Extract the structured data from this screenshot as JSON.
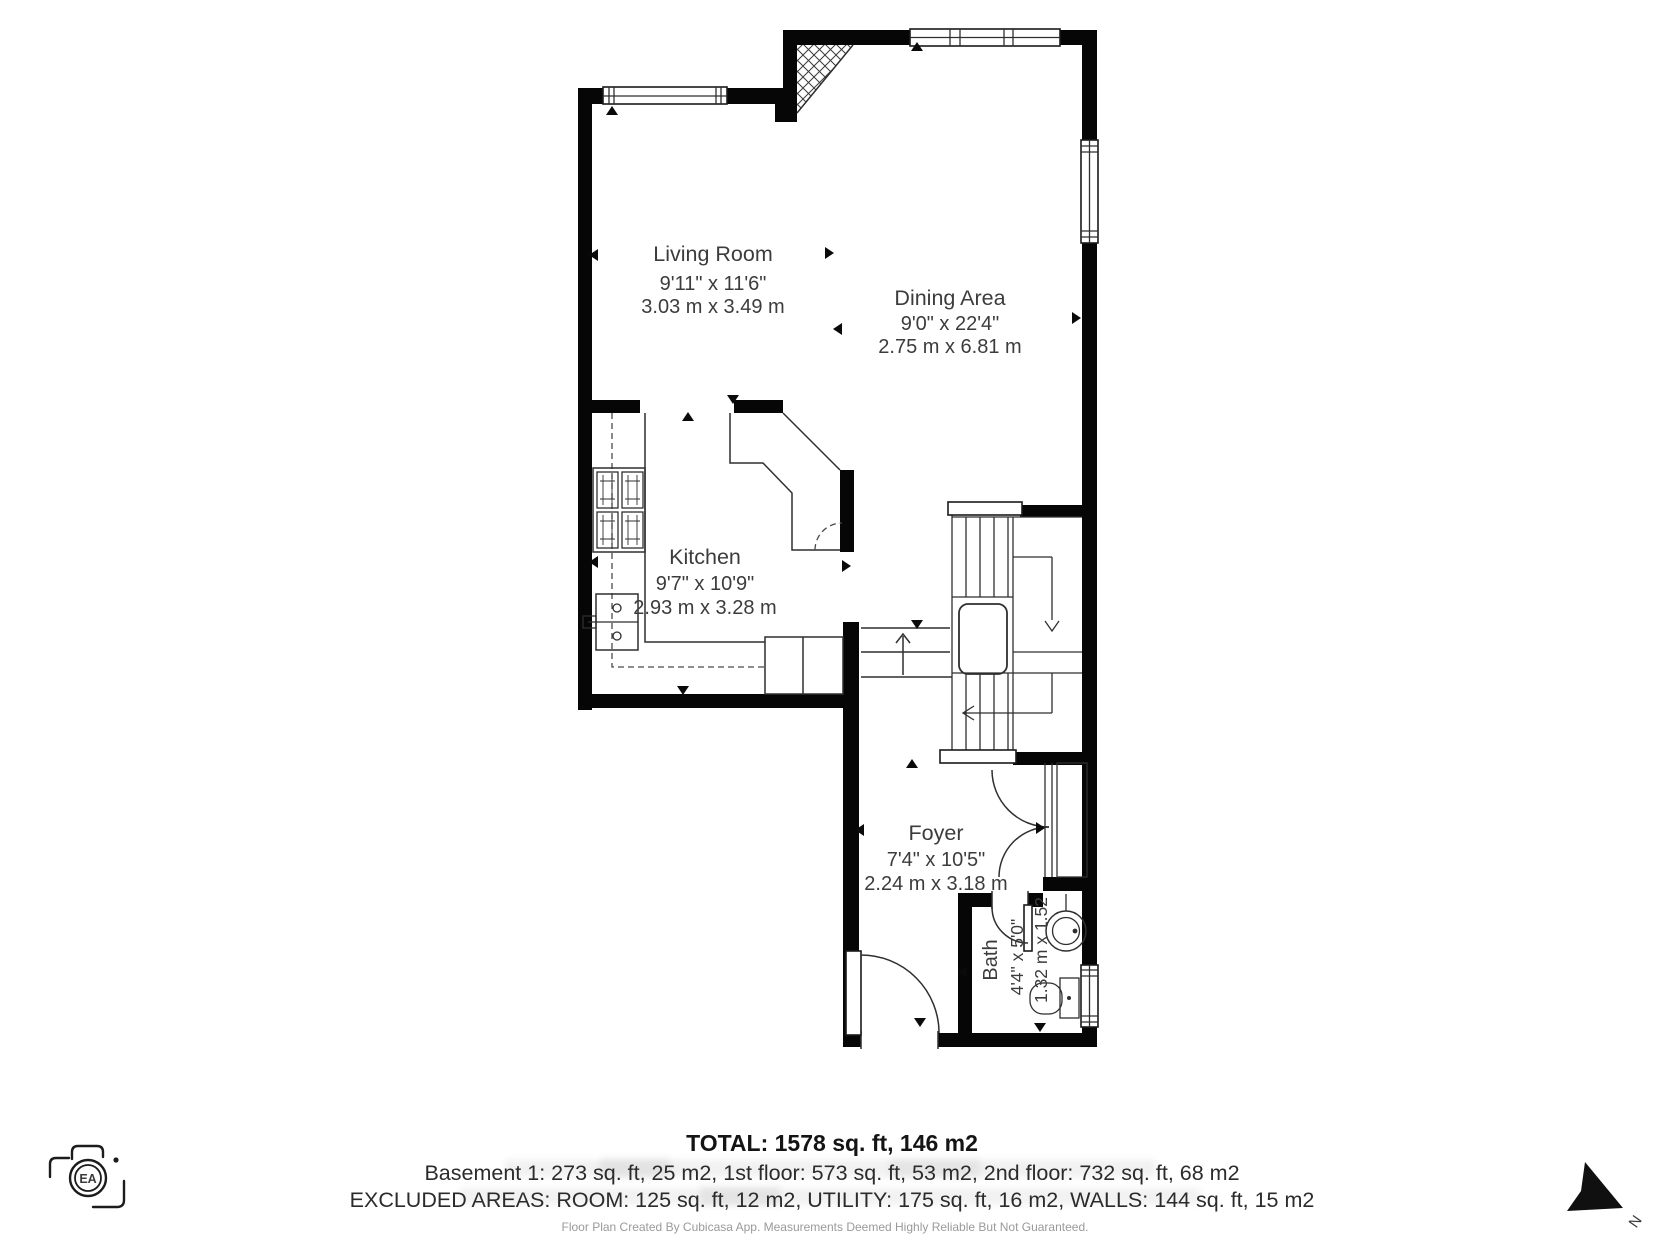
{
  "palette": {
    "wall": "#060606",
    "line": "#2f2f2f",
    "label": "#3c3c3c",
    "fine_print": "#9a9a9a"
  },
  "rooms": [
    {
      "name": "Living Room",
      "imperial": "9'11\" x 11'6\"",
      "metric": "3.03 m x 3.49 m"
    },
    {
      "name": "Dining Area",
      "imperial": "9'0\" x 22'4\"",
      "metric": "2.75 m x 6.81 m"
    },
    {
      "name": "Kitchen",
      "imperial": "9'7\" x 10'9\"",
      "metric": "2.93 m x 3.28 m"
    },
    {
      "name": "Foyer",
      "imperial": "7'4\" x 10'5\"",
      "metric": "2.24 m x 3.18 m"
    },
    {
      "name": "Bath",
      "imperial": "4'4\" x 5'0\"",
      "metric": "1.32 m x 1.52"
    }
  ],
  "summary": {
    "total": "TOTAL: 1578 sq. ft, 146 m2",
    "floors": "Basement 1: 273 sq. ft, 25 m2, 1st floor: 573 sq. ft, 53 m2, 2nd floor: 732 sq. ft, 68 m2",
    "excluded": "EXCLUDED AREAS: ROOM: 125 sq. ft, 12 m2, UTILITY: 175 sq. ft, 16 m2, WALLS: 144 sq. ft, 15 m2",
    "disclaimer": "Floor Plan Created By Cubicasa App. Measurements Deemed Highly Reliable But Not Guaranteed."
  },
  "logo": {
    "text": "EA"
  },
  "compass": {
    "label": "N"
  }
}
